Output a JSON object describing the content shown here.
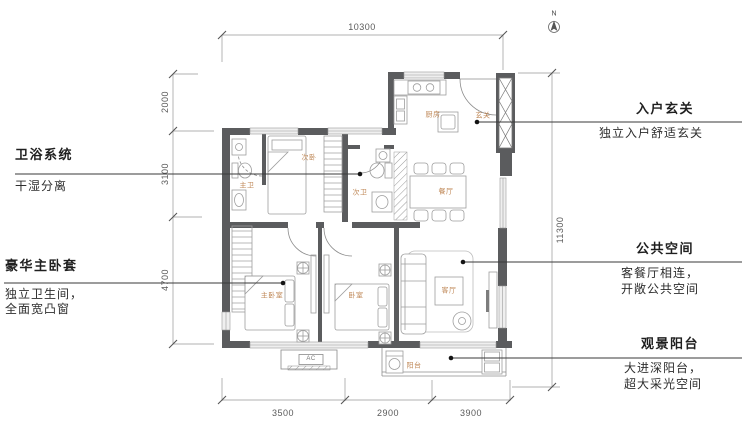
{
  "page": {
    "compass_label": "N"
  },
  "dimensions": {
    "top": "10300",
    "right": "11300",
    "left": [
      "2000",
      "3100",
      "4700"
    ],
    "bottom": [
      "3500",
      "2900",
      "3900"
    ]
  },
  "rooms": [
    {
      "label": "主卫"
    },
    {
      "label": "次卧"
    },
    {
      "label": "次卫"
    },
    {
      "label": "厨房"
    },
    {
      "label": "玄关"
    },
    {
      "label": "餐厅"
    },
    {
      "label": "主卧室"
    },
    {
      "label": "卧室"
    },
    {
      "label": "客厅"
    },
    {
      "label": "阳台"
    },
    {
      "label": "AC"
    }
  ],
  "annotations": {
    "left": [
      {
        "title": "卫浴系统",
        "desc1": "干湿分离",
        "desc2": ""
      },
      {
        "title": "豪华主卧套",
        "desc1": "独立卫生间，",
        "desc2": "全面宽凸窗"
      }
    ],
    "right": [
      {
        "title": "入户玄关",
        "desc1": "独立入户舒适玄关",
        "desc2": ""
      },
      {
        "title": "公共空间",
        "desc1": "客餐厅相连，",
        "desc2": "开敞公共空间"
      },
      {
        "title": "观景阳台",
        "desc1": "大进深阳台，",
        "desc2": "超大采光空间"
      }
    ]
  },
  "colors": {
    "wall": "#5b5c5e",
    "furniture_line": "#9e9e9e",
    "room_label": "#bf8756",
    "leader": "#3a3a3a",
    "dimension": "#5a5a5a"
  }
}
